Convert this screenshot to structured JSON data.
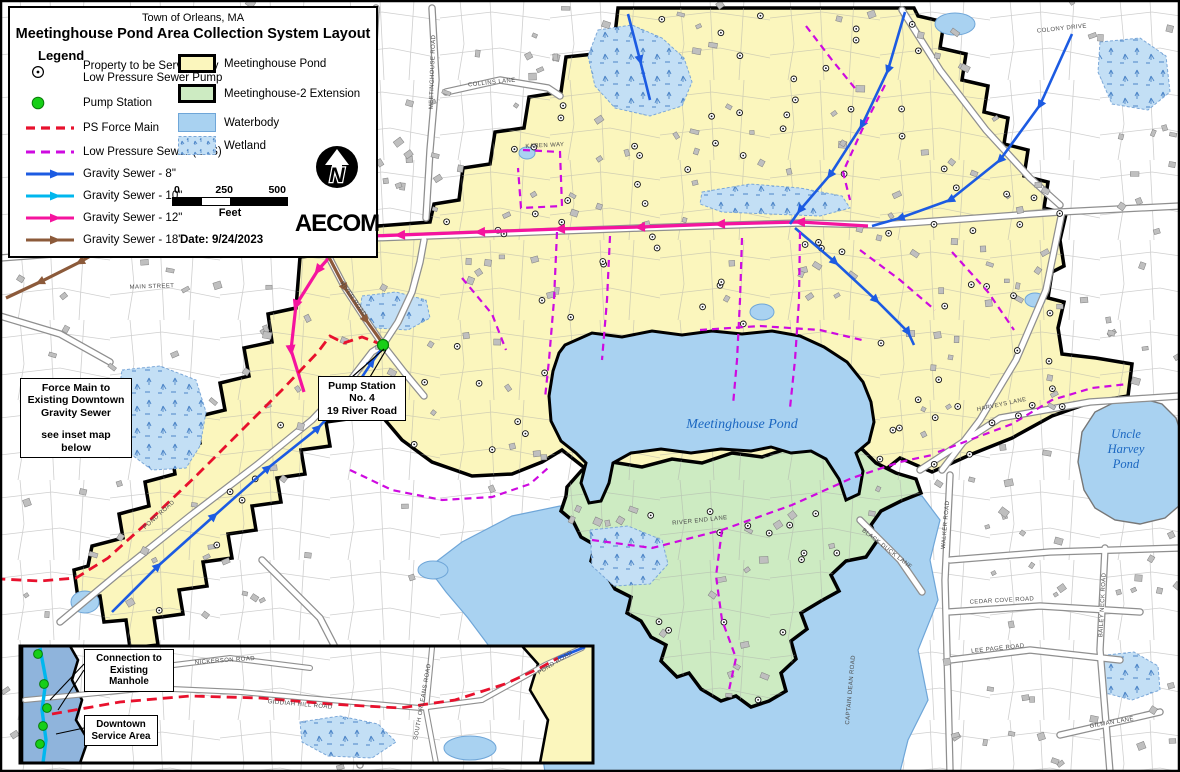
{
  "map": {
    "town": "Town of Orleans, MA",
    "title": "Meetinghouse Pond Area Collection System Layout",
    "date": "Date: 9/24/2023",
    "logo": "AECOM",
    "north_letter": "N"
  },
  "legend": {
    "heading": "Legend",
    "property_label_1": "Property to be Serviced by",
    "property_label_2": "Low Pressure Sewer Pump",
    "pump_station": "Pump Station",
    "force_main": "PS Force Main",
    "lps": "Low Pressure Sewer (LPS)",
    "gravity_8": "Gravity Sewer - 8\"",
    "gravity_10": "Gravity Sewer - 10\"",
    "gravity_12": "Gravity Sewer - 12\"",
    "gravity_18": "Gravity Sewer - 18\"",
    "area_pond": "Meetinghouse Pond",
    "area_extension": "Meetinghouse-2 Extension",
    "area_waterbody": "Waterbody",
    "area_wetland": "Wetland",
    "scale_0": "0",
    "scale_250": "250",
    "scale_500": "500",
    "scale_unit": "Feet"
  },
  "colors": {
    "service_area": "#FBF6BD",
    "extension_area": "#CDEBC2",
    "waterbody": "#A9D2F1",
    "downtown_area": "#8FB4DC",
    "force_main": "#E8112D",
    "lps": "#CE0AE0",
    "gravity_8": "#1C5BE2",
    "gravity_10": "#00B7EE",
    "gravity_12": "#F5149E",
    "gravity_18": "#8C5A3A",
    "pump_station": "#17CF17"
  },
  "callouts": {
    "force_main": {
      "line1": "Force Main to",
      "line2": "Existing Downtown",
      "line3": "Gravity Sewer",
      "line4": "see inset map below"
    },
    "pump_station": {
      "line1": "Pump Station No. 4",
      "line2": "19 River Road"
    }
  },
  "water_labels": {
    "meetinghouse": "Meetinghouse Pond",
    "uncle_1": "Uncle",
    "uncle_2": "Harvey",
    "uncle_3": "Pond"
  },
  "roads": {
    "main_street": "MAIN STREET",
    "meetinghouse_road": "MEETINGHOUSE ROAD",
    "collins_lane": "COLLINS LANE",
    "karen_way": "KAREN WAY",
    "pond_road": "POND ROAD",
    "river_road": "RIVER ROAD",
    "colony_drive": "COLONY DRIVE",
    "harveys_lane": "HARVEYS LANE",
    "river_end_lane": "RIVER END LANE",
    "black_duck_lane": "BLACK DUCK LANE",
    "walker_road": "WALKER ROAD",
    "cedar_cove_road": "CEDAR COVE ROAD",
    "captain_dean_road": "CAPTAIN DEAN ROAD",
    "lee_page_road": "LEE PAGE ROAD",
    "bailey_neck_road": "BAILEY NECK ROAD",
    "gilman_lane": "GILMAN LANE"
  },
  "inset": {
    "callout_connection_1": "Connection to",
    "callout_connection_2": "Existing Manhole",
    "callout_downtown_1": "Downtown",
    "callout_downtown_2": "Service Area",
    "roads": {
      "nickerson_road": "NICKERSON ROAD",
      "finlay_road": "FINLAY ROAD",
      "giddiah_hill_road": "GIDDIAH HILL ROAD",
      "south_orleans_road": "SOUTH ORLEANS ROAD",
      "pond_road": "POND ROAD"
    }
  }
}
